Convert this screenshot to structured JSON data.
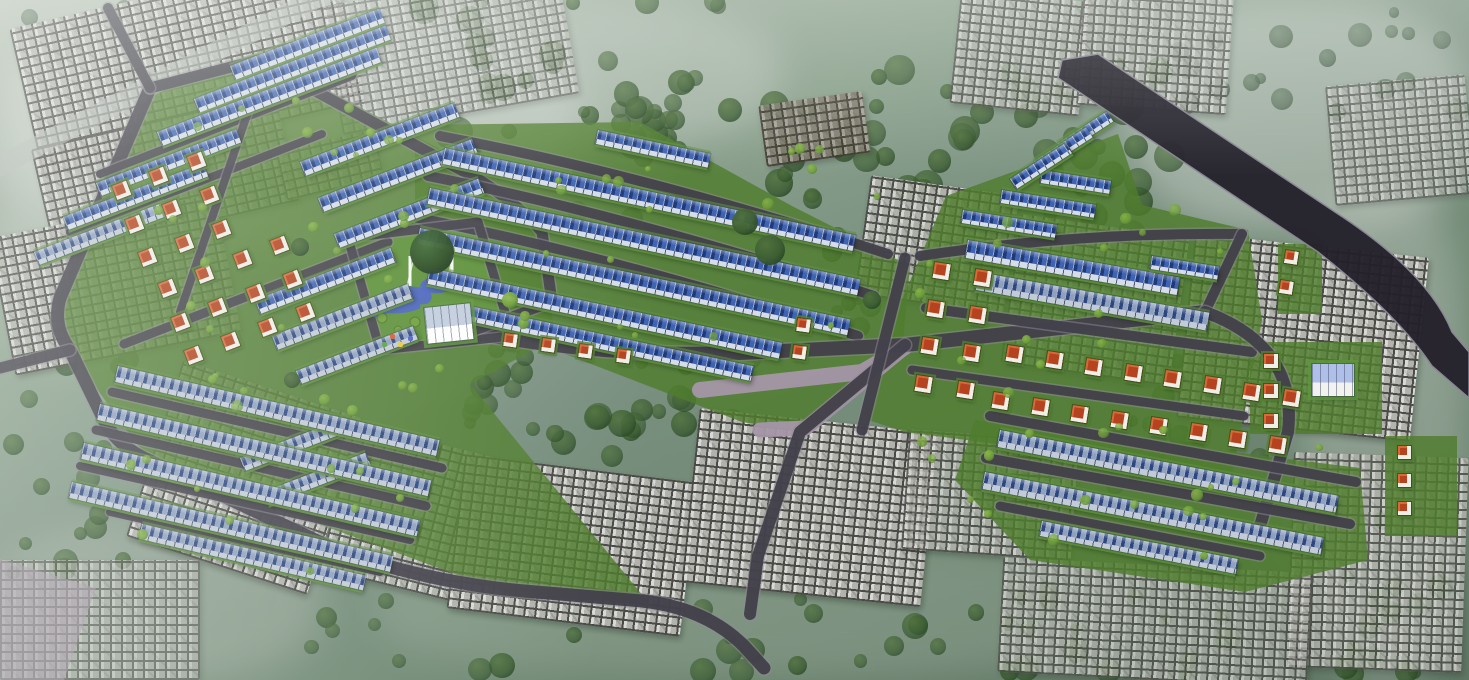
{
  "scene": {
    "title": "aerial-master-plan-rendering-of-residential-development",
    "canvas": {
      "width": 1469,
      "height": 680
    },
    "seed": 7,
    "palette": {
      "road_dark": "#413f49",
      "road_kerb": "#8f8b96",
      "road_mauve": "#a596a8",
      "road_pale": "#b7bdb7",
      "road_black": "#24212b",
      "road_black_edge": "#8a8794",
      "grass": "#4f7c2d",
      "park_grass": "#5d9139",
      "roof_blue_a": "#1e3a7a",
      "roof_blue_b": "#3e63b2",
      "roof_steel_a": "#2c477f",
      "roof_steel_b": "#8fa0bf",
      "facade": "#d7dde8",
      "facade_steel": "#c3cbd8",
      "unit_line": "rgba(255,255,255,0.55)",
      "roof_red": "#b5431f",
      "roof_red_hi": "#d86a3a",
      "villa_wall": "#efefe8",
      "urban_block": "#c9c9c0",
      "urban_seam": "#46463f",
      "urban_mid": "#7a7a70",
      "brown_block": "#8a7a60",
      "brown_seam": "#3e3226",
      "pond": "#4a62c8",
      "fountain": "#ffffff",
      "bldg_roof": "#aebfe8",
      "bldg_wall": "#f2f2ee",
      "park_bldg_roof": "#c3cede",
      "tree": {
        "dark": [
          "#50713c",
          "#3b5c33",
          "#24421f"
        ],
        "mid": [
          "#6a816a",
          "#556c56",
          "#3f543f"
        ],
        "shrub": [
          "#8db84a",
          "#6fa03b",
          "#4e7527"
        ],
        "park": [
          "#3f6a35",
          "#27481f",
          "#16321a"
        ]
      }
    },
    "haze": [
      {
        "x": 0,
        "y": 0,
        "w": 580,
        "h": 250,
        "c": "#d2d8d1",
        "o": 0.5
      },
      {
        "x": 300,
        "y": 0,
        "w": 480,
        "h": 150,
        "c": "#c6cec7",
        "o": 0.42
      },
      {
        "x": 1130,
        "y": 0,
        "w": 339,
        "h": 230,
        "c": "#ccd2cb",
        "o": 0.48
      },
      {
        "x": 1300,
        "y": 180,
        "w": 169,
        "h": 500,
        "c": "#c2cac2",
        "o": 0.38
      },
      {
        "x": 380,
        "y": 540,
        "w": 760,
        "h": 140,
        "c": "#9aab9b",
        "o": 0.4
      },
      {
        "x": 0,
        "y": 520,
        "w": 320,
        "h": 160,
        "c": "#a9b5a8",
        "o": 0.42
      },
      {
        "x": 0,
        "y": 60,
        "w": 160,
        "h": 300,
        "c": "#c8cfc8",
        "o": 0.45
      }
    ],
    "tree_regions_under": [
      [
        420,
        0,
        360,
        150,
        38,
        6,
        15,
        "dark"
      ],
      [
        740,
        60,
        430,
        180,
        60,
        7,
        16,
        "dark"
      ],
      [
        470,
        330,
        280,
        130,
        30,
        6,
        14,
        "dark"
      ],
      [
        0,
        320,
        130,
        260,
        20,
        6,
        13,
        "dark"
      ],
      [
        240,
        590,
        1000,
        85,
        40,
        6,
        14,
        "dark"
      ],
      [
        1110,
        330,
        150,
        160,
        16,
        5,
        12,
        "dark"
      ],
      [
        1330,
        520,
        139,
        155,
        16,
        6,
        13,
        "dark"
      ],
      [
        0,
        0,
        220,
        100,
        14,
        5,
        11,
        "mid"
      ],
      [
        1150,
        0,
        319,
        120,
        20,
        5,
        12,
        "mid"
      ],
      [
        830,
        240,
        90,
        100,
        12,
        5,
        11,
        "dark"
      ],
      [
        550,
        90,
        140,
        140,
        16,
        6,
        13,
        "dark"
      ]
    ],
    "tree_regions_over": [
      [
        150,
        90,
        330,
        300,
        22,
        3,
        6,
        "shrub"
      ],
      [
        380,
        130,
        500,
        210,
        24,
        3,
        6,
        "shrub"
      ],
      [
        920,
        210,
        340,
        250,
        20,
        3,
        6,
        "shrub"
      ],
      [
        970,
        430,
        390,
        130,
        14,
        3,
        6,
        "shrub"
      ],
      [
        80,
        350,
        380,
        230,
        18,
        3,
        6,
        "shrub"
      ]
    ],
    "specific_trees": [
      {
        "x": 432,
        "y": 252,
        "r": 22,
        "v": "park"
      },
      {
        "x": 300,
        "y": 247,
        "r": 9,
        "v": "dark"
      },
      {
        "x": 770,
        "y": 250,
        "r": 15,
        "v": "dark"
      },
      {
        "x": 745,
        "y": 222,
        "r": 13,
        "v": "dark"
      },
      {
        "x": 292,
        "y": 380,
        "r": 8,
        "v": "dark"
      },
      {
        "x": 510,
        "y": 300,
        "r": 8,
        "v": "shrub"
      },
      {
        "x": 872,
        "y": 300,
        "r": 9,
        "v": "dark"
      }
    ],
    "urban_clusters": [
      [
        22,
        -10,
        330,
        150,
        -13,
        0.9
      ],
      [
        40,
        120,
        250,
        110,
        -13,
        0.85
      ],
      [
        0,
        215,
        230,
        140,
        -11,
        0.9
      ],
      [
        280,
        140,
        100,
        50,
        -13,
        0.8
      ],
      [
        330,
        -15,
        240,
        130,
        -10,
        0.6
      ],
      [
        150,
        385,
        190,
        185,
        18,
        0.95
      ],
      [
        335,
        440,
        160,
        150,
        14,
        0.9
      ],
      [
        455,
        468,
        235,
        155,
        7,
        0.95
      ],
      [
        690,
        420,
        240,
        175,
        6,
        0.95
      ],
      [
        905,
        435,
        170,
        120,
        4,
        0.8
      ],
      [
        955,
        -5,
        130,
        115,
        6,
        0.75
      ],
      [
        1080,
        -10,
        150,
        120,
        4,
        0.7
      ],
      [
        862,
        185,
        150,
        120,
        8,
        0.9
      ],
      [
        1010,
        225,
        170,
        150,
        8,
        0.9
      ],
      [
        1185,
        245,
        235,
        185,
        6,
        0.95
      ],
      [
        1290,
        455,
        175,
        215,
        2,
        0.75
      ],
      [
        1000,
        565,
        310,
        115,
        3,
        0.7
      ],
      [
        1330,
        80,
        140,
        120,
        -5,
        0.6
      ],
      [
        0,
        560,
        200,
        120,
        0,
        0.6
      ]
    ],
    "brown_clusters": [
      [
        762,
        98,
        105,
        62,
        -8,
        0.85
      ]
    ],
    "green_zones": [
      "M152,86 L262,56 L438,148 L536,226 L556,338 L470,384 L648,602 L520,598 L150,462 L70,352 L58,298 Z",
      "M415,125 L640,122 L792,206 L910,266 L902,352 L806,432 L742,422 L560,352 L415,240 Z",
      "M946,196 L1118,134 L1142,205 L1248,230 L1262,320 L1232,476 L1150,464 L905,432 L868,420 L902,300 Z",
      "M975,420 L1360,468 L1368,560 L1245,592 L1030,560 L955,480 Z",
      "M1250,342 h132 v92 h-132 Z",
      "M1385,436 h72 v100 h-72 Z",
      "M1278,244 h44 v70 h-44 Z"
    ],
    "park": {
      "lawn": "M346,236 L480,220 L514,338 L380,350 Z",
      "pond": [
        [
          402,
          300,
          30,
          13,
          -8
        ],
        [
          440,
          284,
          20,
          9,
          -8
        ],
        [
          376,
          310,
          12,
          7,
          0
        ]
      ],
      "fountains": [
        [
          410,
          286,
          410,
          256
        ],
        [
          452,
          272,
          452,
          242
        ]
      ],
      "shrubs": [
        [
          382,
          318,
          5
        ],
        [
          398,
          330,
          4
        ],
        [
          415,
          322,
          5
        ],
        [
          372,
          300,
          4
        ],
        [
          458,
          306,
          5
        ],
        [
          470,
          318,
          4
        ],
        [
          368,
          268,
          4
        ]
      ],
      "building": {
        "x": 424,
        "y": 308,
        "w": 46,
        "h": 36,
        "rot": -6
      },
      "playground": [
        {
          "x": 390,
          "y": 334,
          "c": "#d85b35"
        },
        {
          "x": 398,
          "y": 342,
          "c": "#e8c93e"
        },
        {
          "x": 408,
          "y": 336,
          "c": "#4a62c8"
        },
        {
          "x": 382,
          "y": 342,
          "c": "#58a343"
        }
      ]
    },
    "roads": [
      {
        "d": "M-12,172 L332,-10",
        "w": 20,
        "c": "pale"
      },
      {
        "d": "M905,347 L806,428 L760,430",
        "w": 15,
        "c": "mauve"
      },
      {
        "d": "M700,390 L862,372 L905,347",
        "w": 16,
        "c": "mauve"
      },
      {
        "d": "M150,88 L60,298 Q52,326 70,350 L106,424 Q120,448 152,462 L332,548 Q424,582 524,591 L642,601 Q706,608 744,646 L764,668",
        "w": 13,
        "c": "dark"
      },
      {
        "d": "M150,88 L258,60 L476,178 Q520,205 542,232 L552,302",
        "w": 11,
        "c": "dark"
      },
      {
        "d": "M150,88 L108,8",
        "w": 10,
        "c": "dark"
      },
      {
        "d": "M70,350 L0,368",
        "w": 11,
        "c": "dark"
      },
      {
        "d": "M100,174 L352,76",
        "w": 8,
        "c": "dark"
      },
      {
        "d": "M70,232 L322,134",
        "w": 8,
        "c": "dark"
      },
      {
        "d": "M124,344 L388,242",
        "w": 9,
        "c": "dark"
      },
      {
        "d": "M248,112 L180,312",
        "w": 8,
        "c": "dark"
      },
      {
        "d": "M112,392 L442,468",
        "w": 9,
        "c": "dark"
      },
      {
        "d": "M96,430 L426,506",
        "w": 9,
        "c": "dark"
      },
      {
        "d": "M80,466 L410,540",
        "w": 8,
        "c": "dark"
      },
      {
        "d": "M110,512 L380,572",
        "w": 8,
        "c": "dark"
      },
      {
        "d": "M440,136 Q650,176 888,254",
        "w": 10,
        "c": "dark"
      },
      {
        "d": "M428,176 Q630,216 874,296",
        "w": 10,
        "c": "dark"
      },
      {
        "d": "M418,218 Q620,258 858,336",
        "w": 10,
        "c": "dark"
      },
      {
        "d": "M470,332 Q620,360 760,352 L905,345 Q1010,333 1205,312",
        "w": 14,
        "c": "dark"
      },
      {
        "d": "M348,238 L478,222 L512,336 L380,350 Z",
        "w": 9,
        "c": "dark"
      },
      {
        "d": "M552,302 L470,332",
        "w": 10,
        "c": "dark"
      },
      {
        "d": "M905,345 L800,432 L758,556 L750,614",
        "w": 12,
        "c": "dark"
      },
      {
        "d": "M920,256 Q1080,232 1242,234",
        "w": 10,
        "c": "dark"
      },
      {
        "d": "M926,308 L1252,352",
        "w": 10,
        "c": "dark"
      },
      {
        "d": "M912,370 L1244,416",
        "w": 9,
        "c": "dark"
      },
      {
        "d": "M905,258 L862,430",
        "w": 11,
        "c": "dark"
      },
      {
        "d": "M1242,234 L1205,312",
        "w": 10,
        "c": "dark"
      },
      {
        "d": "M1205,312 Q1298,346 1288,432 L1260,526",
        "w": 12,
        "c": "dark"
      },
      {
        "d": "M990,416 L1356,482",
        "w": 10,
        "c": "dark"
      },
      {
        "d": "M986,458 L1350,524",
        "w": 10,
        "c": "dark"
      },
      {
        "d": "M1000,506 L1260,556",
        "w": 9,
        "c": "dark"
      }
    ],
    "black_road": "M1062,60 L1098,54 L1335,212 Q1428,272 1452,332 L1469,352 L1469,398 L1432,366 Q1398,315 1318,252 L1058,78 Z",
    "mauve_corner": "M-10,556 L96,588 L64,680 L-10,680 Z",
    "townhouse_rows": [
      [
        230,
        66,
        160,
        15,
        -21,
        0
      ],
      [
        194,
        99,
        205,
        15,
        -21,
        0
      ],
      [
        157,
        132,
        235,
        15,
        -21,
        0
      ],
      [
        96,
        183,
        150,
        14,
        -21,
        0
      ],
      [
        63,
        217,
        150,
        14,
        -21,
        0
      ],
      [
        34,
        252,
        140,
        14,
        -21,
        1
      ],
      [
        300,
        162,
        165,
        15,
        -21,
        0
      ],
      [
        318,
        198,
        165,
        15,
        -21,
        0
      ],
      [
        334,
        234,
        155,
        15,
        -21,
        0
      ],
      [
        255,
        300,
        145,
        15,
        -21,
        0
      ],
      [
        272,
        336,
        145,
        15,
        -21,
        1
      ],
      [
        296,
        371,
        125,
        14,
        -21,
        1
      ],
      [
        240,
        458,
        110,
        14,
        -21,
        1
      ],
      [
        263,
        492,
        110,
        14,
        -21,
        1
      ],
      [
        118,
        366,
        330,
        16,
        13,
        1
      ],
      [
        100,
        404,
        340,
        16,
        13,
        1
      ],
      [
        84,
        443,
        345,
        16,
        13,
        1
      ],
      [
        72,
        482,
        330,
        16,
        13,
        1
      ],
      [
        142,
        524,
        230,
        15,
        13,
        1
      ],
      [
        598,
        130,
        115,
        14,
        12,
        0
      ],
      [
        445,
        148,
        420,
        16,
        12,
        0
      ],
      [
        430,
        188,
        440,
        16,
        12,
        0
      ],
      [
        420,
        228,
        440,
        16,
        12,
        0
      ],
      [
        430,
        268,
        360,
        16,
        12,
        0
      ],
      [
        470,
        306,
        290,
        15,
        12,
        0
      ],
      [
        1042,
        170,
        70,
        13,
        9,
        0
      ],
      [
        1002,
        190,
        95,
        13,
        9,
        0
      ],
      [
        963,
        210,
        95,
        13,
        9,
        0
      ],
      [
        968,
        240,
        215,
        18,
        10,
        0
      ],
      [
        978,
        272,
        235,
        18,
        10,
        1
      ],
      [
        1152,
        256,
        68,
        13,
        9,
        0
      ],
      [
        1000,
        430,
        345,
        17,
        11,
        1
      ],
      [
        985,
        472,
        345,
        17,
        11,
        1
      ],
      [
        1042,
        521,
        200,
        15,
        11,
        1
      ],
      [
        1058,
        143,
        58,
        12,
        -33,
        0
      ],
      [
        1034,
        161,
        62,
        12,
        -33,
        0
      ],
      [
        1010,
        179,
        66,
        12,
        -33,
        0
      ]
    ],
    "villa_blocks": [
      {
        "x": 112,
        "y": 186,
        "cols": 3,
        "rows": 3,
        "dx": 40,
        "dy": 36,
        "s": 15,
        "rot": -21
      },
      {
        "x": 158,
        "y": 284,
        "cols": 4,
        "rows": 3,
        "dx": 40,
        "dy": 36,
        "s": 15,
        "rot": -21
      },
      {
        "x": 505,
        "y": 333,
        "cols": 4,
        "rows": 1,
        "dx": 38,
        "dy": 34,
        "s": 13,
        "rot": 8
      },
      {
        "x": 798,
        "y": 318,
        "cols": 1,
        "rows": 2,
        "dx": 34,
        "dy": 27,
        "s": 13,
        "rot": 8
      },
      {
        "x": 935,
        "y": 262,
        "cols": 2,
        "rows": 4,
        "dx": 42,
        "dy": 38,
        "s": 16,
        "rot": 9
      },
      {
        "x": 1008,
        "y": 345,
        "cols": 8,
        "rows": 1,
        "dx": 40,
        "dy": 38,
        "s": 16,
        "rot": 9
      },
      {
        "x": 994,
        "y": 392,
        "cols": 8,
        "rows": 1,
        "dx": 40,
        "dy": 38,
        "s": 16,
        "rot": 9
      },
      {
        "x": 1264,
        "y": 354,
        "cols": 1,
        "rows": 3,
        "dx": 30,
        "dy": 30,
        "s": 14,
        "rot": 0
      },
      {
        "x": 1398,
        "y": 446,
        "cols": 1,
        "rows": 3,
        "dx": 28,
        "dy": 28,
        "s": 13,
        "rot": 0
      },
      {
        "x": 1286,
        "y": 250,
        "cols": 1,
        "rows": 2,
        "dx": 30,
        "dy": 30,
        "s": 13,
        "rot": 9
      }
    ],
    "east_building": {
      "x": 1312,
      "y": 364,
      "w": 42,
      "h": 32,
      "rot": 0
    }
  }
}
